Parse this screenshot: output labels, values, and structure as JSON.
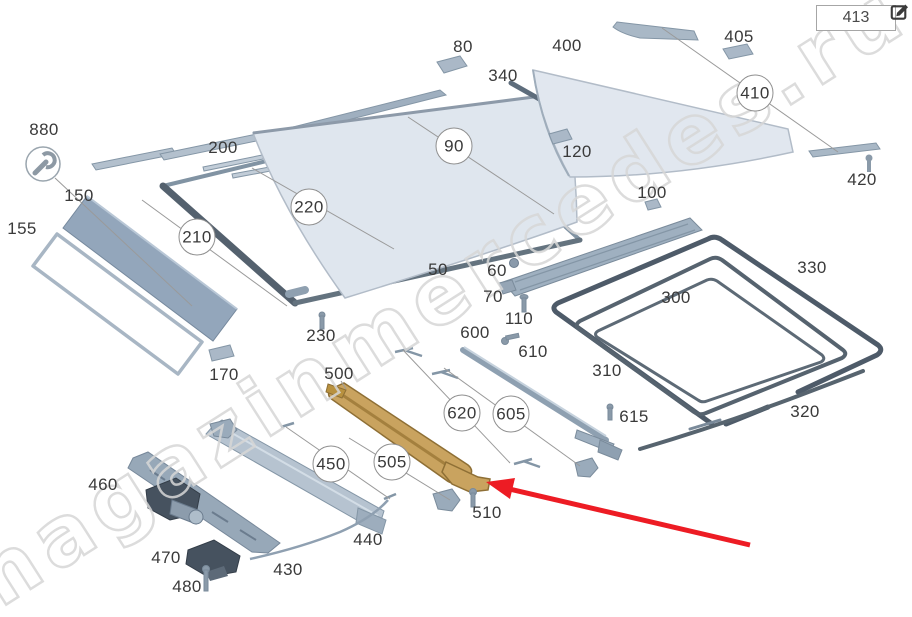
{
  "header": {
    "part_code_box": {
      "value": "413"
    }
  },
  "watermark": {
    "text": "magazinmercedes.ru",
    "color": "#d7d7d7"
  },
  "colors": {
    "background": "#ffffff",
    "part_fill": "#c7d2de",
    "glass_fill": "#dfe6ee",
    "dark_rail": "#54616e",
    "seal": "#4e5b69",
    "highlight_part_gold": "#c9a35f",
    "motor_dark": "#46525f",
    "label_text": "#3a3a3a",
    "leader_line": "#9a9a9a",
    "annotation_arrow_red": "#ed1c24"
  },
  "icons": {
    "edit": "pencil-square-icon",
    "tool_badge": "wrench-icon"
  },
  "labels": [
    {
      "n": "880",
      "x": 44,
      "y": 130,
      "c": false
    },
    {
      "n": "155",
      "x": 22,
      "y": 229,
      "c": false
    },
    {
      "n": "150",
      "x": 79,
      "y": 196,
      "c": false
    },
    {
      "n": "200",
      "x": 223,
      "y": 148,
      "c": false
    },
    {
      "n": "210",
      "x": 197,
      "y": 237,
      "c": true
    },
    {
      "n": "220",
      "x": 309,
      "y": 207,
      "c": true
    },
    {
      "n": "230",
      "x": 321,
      "y": 336,
      "c": false
    },
    {
      "n": "170",
      "x": 224,
      "y": 375,
      "c": false
    },
    {
      "n": "80",
      "x": 463,
      "y": 47,
      "c": false
    },
    {
      "n": "90",
      "x": 454,
      "y": 146,
      "c": true
    },
    {
      "n": "340",
      "x": 503,
      "y": 76,
      "c": false
    },
    {
      "n": "400",
      "x": 567,
      "y": 46,
      "c": false
    },
    {
      "n": "405",
      "x": 739,
      "y": 37,
      "c": false
    },
    {
      "n": "410",
      "x": 755,
      "y": 93,
      "c": true
    },
    {
      "n": "420",
      "x": 862,
      "y": 180,
      "c": false
    },
    {
      "n": "120",
      "x": 577,
      "y": 152,
      "c": false
    },
    {
      "n": "100",
      "x": 652,
      "y": 193,
      "c": false
    },
    {
      "n": "50",
      "x": 438,
      "y": 270,
      "c": false
    },
    {
      "n": "60",
      "x": 497,
      "y": 271,
      "c": false
    },
    {
      "n": "70",
      "x": 493,
      "y": 297,
      "c": false
    },
    {
      "n": "110",
      "x": 519,
      "y": 319,
      "c": false
    },
    {
      "n": "330",
      "x": 812,
      "y": 268,
      "c": false
    },
    {
      "n": "300",
      "x": 676,
      "y": 298,
      "c": false
    },
    {
      "n": "310",
      "x": 607,
      "y": 371,
      "c": false
    },
    {
      "n": "320",
      "x": 805,
      "y": 412,
      "c": false
    },
    {
      "n": "600",
      "x": 475,
      "y": 333,
      "c": false
    },
    {
      "n": "610",
      "x": 533,
      "y": 352,
      "c": false
    },
    {
      "n": "615",
      "x": 634,
      "y": 417,
      "c": false
    },
    {
      "n": "620",
      "x": 462,
      "y": 413,
      "c": true
    },
    {
      "n": "605",
      "x": 511,
      "y": 414,
      "c": true
    },
    {
      "n": "500",
      "x": 339,
      "y": 374,
      "c": false
    },
    {
      "n": "505",
      "x": 392,
      "y": 462,
      "c": true
    },
    {
      "n": "450",
      "x": 331,
      "y": 464,
      "c": true
    },
    {
      "n": "510",
      "x": 487,
      "y": 513,
      "c": false
    },
    {
      "n": "440",
      "x": 368,
      "y": 540,
      "c": false
    },
    {
      "n": "430",
      "x": 288,
      "y": 570,
      "c": false
    },
    {
      "n": "460",
      "x": 103,
      "y": 485,
      "c": false
    },
    {
      "n": "470",
      "x": 166,
      "y": 558,
      "c": false
    },
    {
      "n": "480",
      "x": 187,
      "y": 587,
      "c": false
    }
  ]
}
